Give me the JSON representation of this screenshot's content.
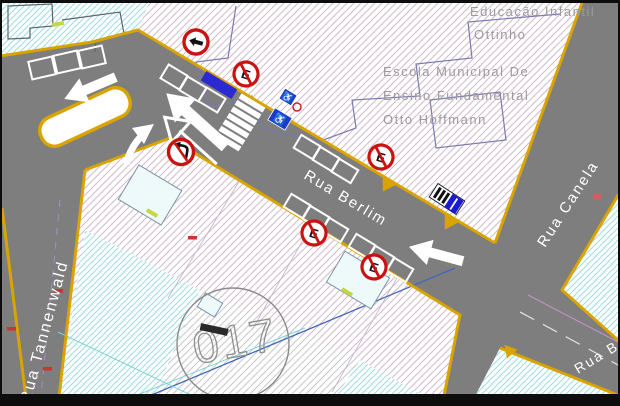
{
  "map": {
    "school": {
      "line1": "Educação Infantil",
      "line2": "Ottinho",
      "line3": "Escola Municipal De",
      "line4": "Ensino Fundamental",
      "line5": "Otto Hoffmann"
    },
    "streets": {
      "berlim": "Rua Berlim",
      "canela": "Rua Canela",
      "tannenwald": "Rua Tannenwald",
      "berlim_east": "Rua B"
    },
    "block_number": "017",
    "signs": {
      "no_parking_letter": "E",
      "icons": [
        "one-way-left-sign",
        "no-parking-sign",
        "no-left-turn-sign",
        "wheelchair-sign",
        "bus-stop-marker",
        "left-arrow-marking",
        "straight-arrow-marking",
        "curved-arrow-marking",
        "crosswalk"
      ]
    },
    "colors": {
      "road": "#7e7e7e",
      "curb_yellow": "#d9a400",
      "sign_red": "#cc1111",
      "marking_white": "#ffffff",
      "bay_blue": "#2a2ad0",
      "cyan_hatch": "#9edede",
      "pink_hatch": "#cfb6c6",
      "lot_line": "#c490c4"
    }
  }
}
